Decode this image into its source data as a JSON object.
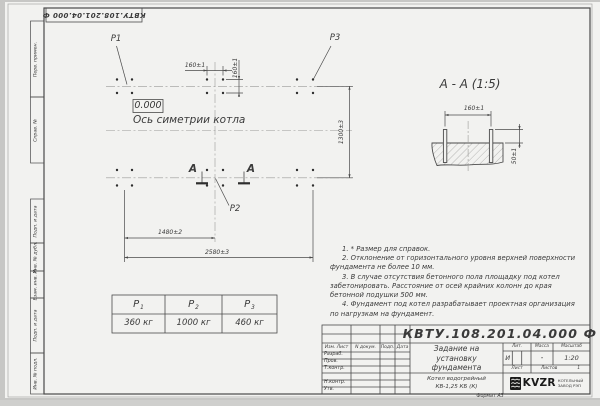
{
  "colors": {
    "paper": "#f2f2f0",
    "line": "#4a4a4a",
    "text": "#3a3a3a",
    "logo_black": "#1a1a1a"
  },
  "stamp_top": {
    "text": "КВТУ.108.201.04.000 Ф"
  },
  "margin": {
    "cells": [
      "Перв. примен.",
      "Справ. №",
      "Подп. и дата",
      "Инв. № дубл.",
      "Взам. инв. №",
      "Подп. и дата",
      "Инв. № подл."
    ]
  },
  "plan": {
    "labels": {
      "p1": "P1",
      "p2": "P2",
      "p3": "P3"
    },
    "level_mark": "0.000",
    "axis_label": "Ось симетрии котла",
    "section_letter": "А",
    "dims": {
      "bolt_spacing_h": "160±1",
      "bolt_spacing_v": "160±1",
      "row_spacing": "1300±3",
      "span_partial": "1480±2",
      "span_total": "2580±3"
    }
  },
  "section": {
    "title": "А - А (1:5)",
    "dims": {
      "bolt_spacing": "160±1",
      "protrusion": "50±1"
    }
  },
  "loads": {
    "headers": [
      {
        "base": "P",
        "sub": "1"
      },
      {
        "base": "P",
        "sub": "2"
      },
      {
        "base": "P",
        "sub": "3"
      }
    ],
    "values": [
      "360 кг",
      "1000 кг",
      "460 кг"
    ]
  },
  "notes": {
    "items": [
      "1. * Размер для справок.",
      "2. Отклонение от горизонтального уровня верхней поверхности фундамента не более 10 мм.",
      "3. В случае отсутствия бетонного пола площадку под котел забетонировать. Расстояние от осей крайних колонн до края бетонной подушки 500 мм.",
      "4. Фундамент под котел разрабатывает проектная организация по нагрузкам на фундамент."
    ]
  },
  "title_block": {
    "designation": "КВТУ.108.201.04.000 Ф",
    "doc_title_lines": [
      "Задание на",
      "установку",
      "фундамента"
    ],
    "product_lines": [
      "Котел водогрейный",
      "КВ-1,25 КБ  (К)"
    ],
    "col_headers": {
      "izm": "Изм. Лист",
      "doc": "N докум.",
      "sign": "Подп.",
      "date": "Дата"
    },
    "row_labels": [
      "Разраб.",
      "Пров.",
      "Т.контр.",
      "",
      "Н.контр.",
      "Утв."
    ],
    "lit_label": "Лит.",
    "mass_label": "Масса",
    "scale_label": "Масштаб",
    "lit_value": "И",
    "mass_value": "-",
    "scale_value": "1:20",
    "sheet_label": "Лист",
    "sheets_label": "Листов",
    "sheets_value": "1",
    "logo": {
      "text": "KVZR",
      "caption_lines": [
        "КОТЕЛЬНЫЙ",
        "ЗАВОД РЭП"
      ]
    },
    "format_label": "Формат А3"
  }
}
